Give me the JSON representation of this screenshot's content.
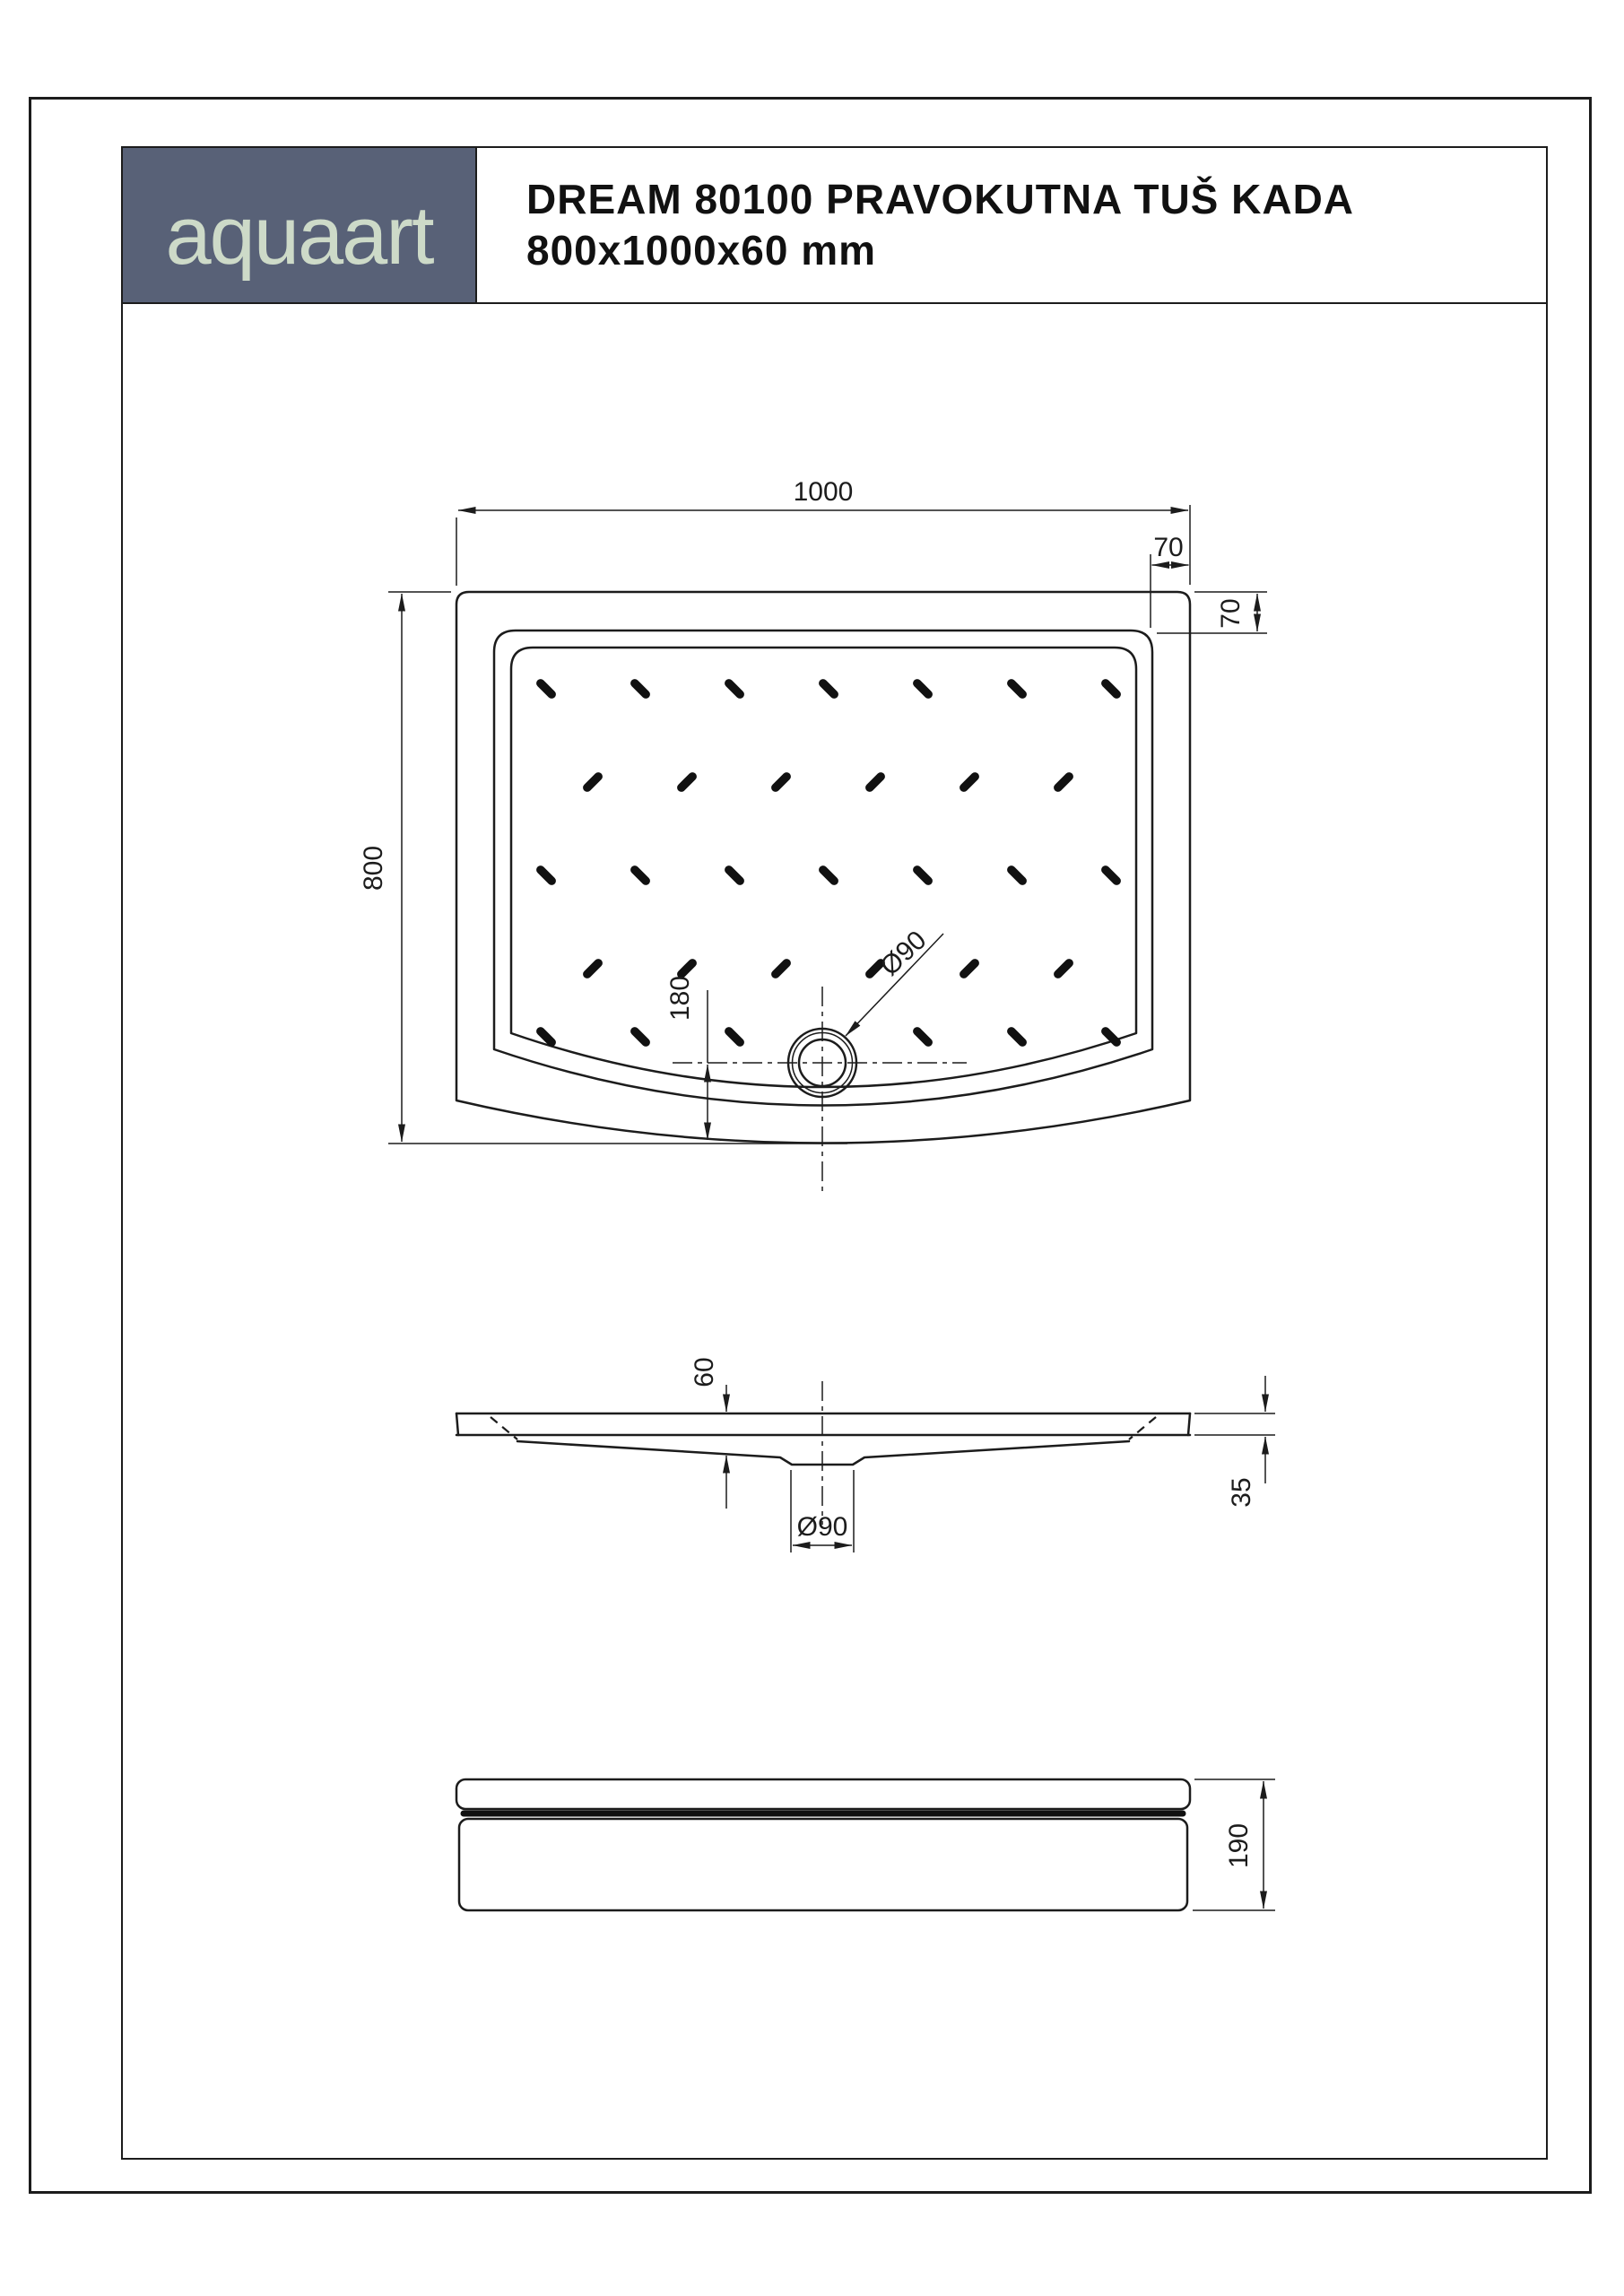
{
  "header": {
    "logo_text": "aquaart",
    "logo_bg": "#586177",
    "logo_fg": "#cddac8",
    "title_line1": "DREAM 80100 PRAVOKUTNA TUŠ KADA",
    "title_line2": "800x1000x60 mm"
  },
  "top_view": {
    "dim_width": "1000",
    "dim_height": "800",
    "dim_rim_top": "70",
    "dim_rim_right": "70",
    "dim_drain_offset": "180",
    "drain_label": "Ø90"
  },
  "side_view": {
    "dim_depth": "60",
    "dim_edge": "35",
    "drain_label": "Ø90"
  },
  "front_view": {
    "dim_height": "190"
  }
}
